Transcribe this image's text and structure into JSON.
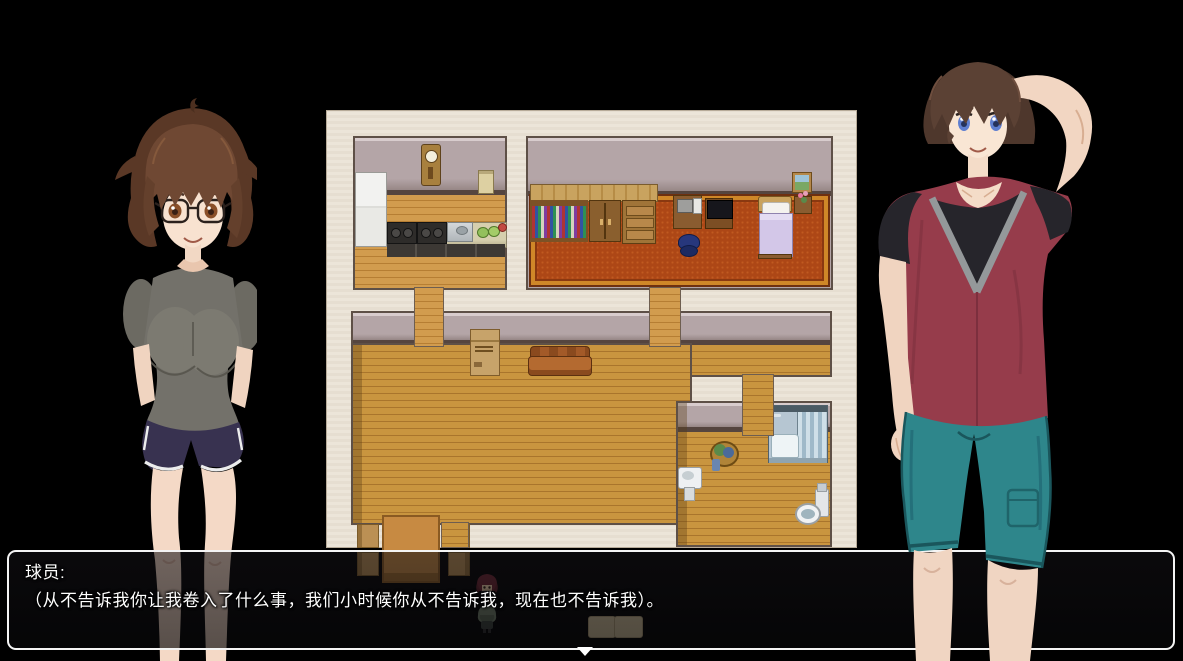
{
  "dialogue": {
    "speaker": "球员:",
    "text": "（从不告诉我你让我卷入了什么事，我们小时候你从不告诉我，现在也不告诉我）。",
    "continue_indicator": "▼"
  },
  "characters": {
    "left_bust": "female-brown-hair-glasses-gray-shirt",
    "right_bust": "male-brown-hair-red-hoodie-teal-shorts"
  },
  "map_rooms": [
    "kitchen",
    "bedroom",
    "hallway",
    "living-dining-room",
    "bathroom"
  ],
  "palette": {
    "background": "#000000",
    "map_background": "#ece5d9",
    "room_wall": "#b4a5a7",
    "wood_floor": "#c9953f",
    "carpet": "#ad4716",
    "dialog_border": "#f4f4f4",
    "dialog_background": "rgba(10,10,12,0.62)",
    "female_shirt": "#73716a",
    "female_shorts": "#383250",
    "male_hoodie": "#963c4b",
    "male_shorts": "#2e868b",
    "hair_brown": "#5b4134",
    "skin": "#f4dcc8"
  }
}
